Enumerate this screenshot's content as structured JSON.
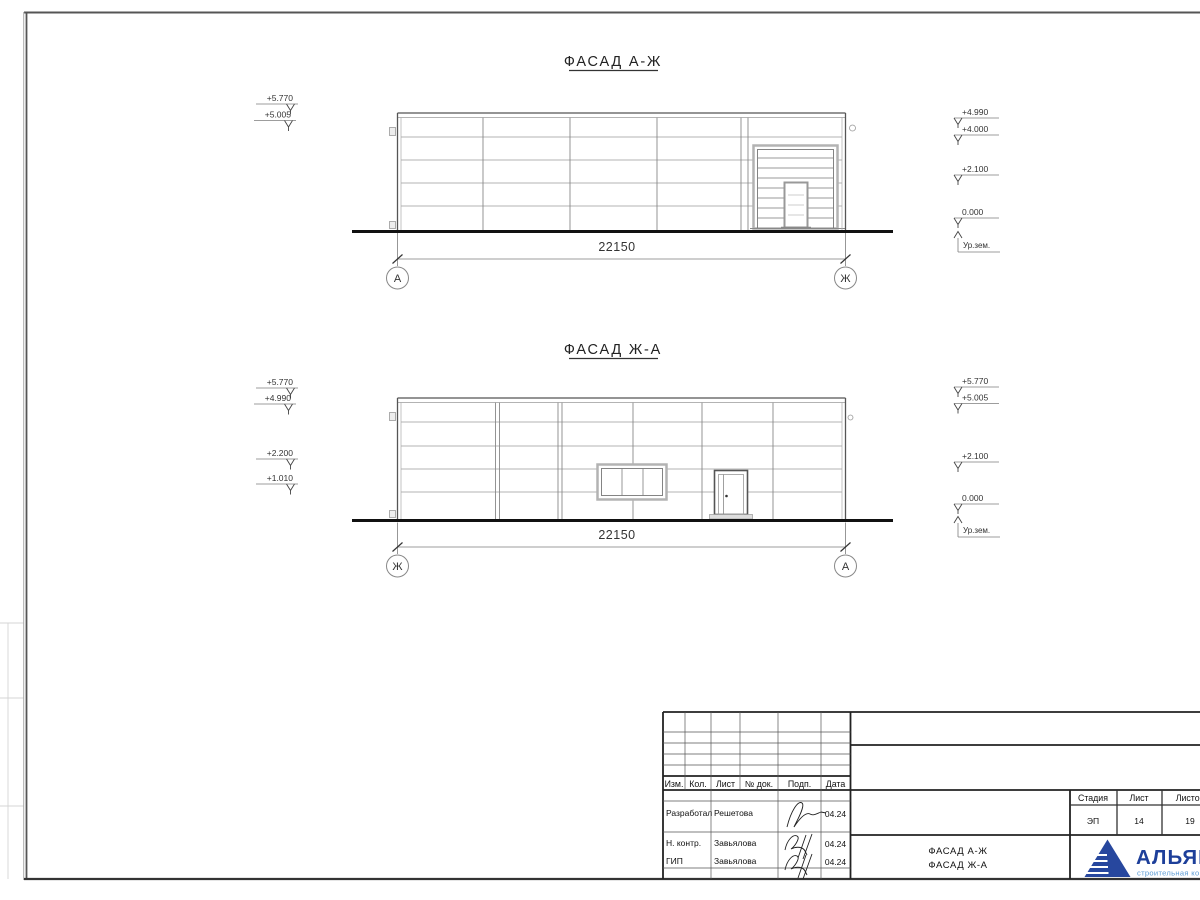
{
  "facades": [
    {
      "title": "ФАСАД А-Ж",
      "dim": "22150",
      "axis_left": "А",
      "axis_right": "Ж",
      "marks_left": [
        "+5.770",
        "+5.005"
      ],
      "marks_right": [
        "+4.990",
        "+4.000",
        "+2.100",
        "0.000"
      ],
      "ground_label": "Ур.зем."
    },
    {
      "title": "ФАСАД Ж-А",
      "dim": "22150",
      "axis_left": "Ж",
      "axis_right": "А",
      "marks_left": [
        "+5.770",
        "+4.990",
        "+2.200",
        "+1.010"
      ],
      "marks_right": [
        "+5.770",
        "+5.005",
        "+2.100",
        "0.000"
      ],
      "ground_label": "Ур.зем."
    }
  ],
  "titleblock": {
    "header": [
      "Изм.",
      "Кол.",
      "Лист",
      "№ док.",
      "Подп.",
      "Дата"
    ],
    "rows": [
      {
        "role": "Разработал",
        "name": "Решетова",
        "date": "04.24"
      },
      {
        "role": "Н. контр.",
        "name": "Завьялова",
        "date": "04.24"
      },
      {
        "role": "ГИП",
        "name": "Завьялова",
        "date": "04.24"
      }
    ],
    "stage": {
      "label": "Стадия",
      "value": "ЭП"
    },
    "sheet": {
      "label": "Лист",
      "value": "14"
    },
    "sheets": {
      "label": "Листов",
      "value": "19"
    },
    "doc_title": [
      "ФАСАД А-Ж",
      "ФАСАД Ж-А"
    ],
    "logo": {
      "name": "АЛЬЯНС",
      "tagline": "строительная компания",
      "brand_color": "#1d3f9a",
      "tagline_color": "#5b9bd5"
    }
  }
}
